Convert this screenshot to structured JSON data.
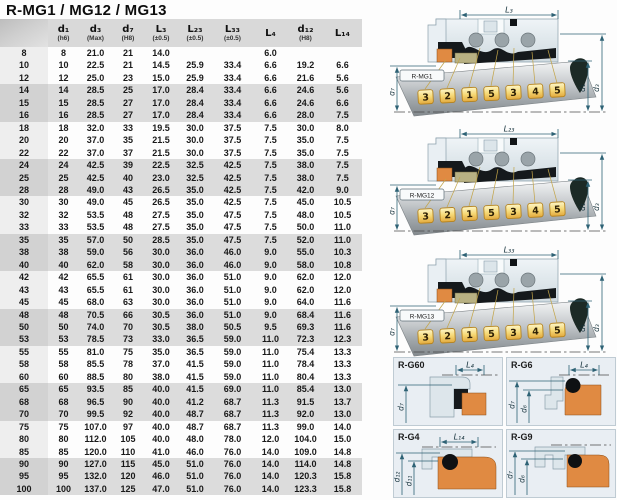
{
  "title": "R-MG1 / MG12 / MG13",
  "table": {
    "headers": [
      {
        "name": "d₁",
        "tol": "(h6)"
      },
      {
        "name": "d₃",
        "tol": "(Max)"
      },
      {
        "name": "d₇",
        "tol": "(H8)"
      },
      {
        "name": "L₃",
        "tol": "(±0.5)"
      },
      {
        "name": "L₂₃",
        "tol": "(±0.5)"
      },
      {
        "name": "L₃₃",
        "tol": "(±0.5)"
      },
      {
        "name": "L₄",
        "tol": ""
      },
      {
        "name": "d₁₂",
        "tol": "(H8)"
      },
      {
        "name": "L₁₄",
        "tol": ""
      }
    ],
    "rows": [
      [
        "8",
        "8",
        "21.0",
        "21",
        "14.0",
        "",
        "",
        "6.0",
        "",
        ""
      ],
      [
        "10",
        "10",
        "22.5",
        "21",
        "14.5",
        "25.9",
        "33.4",
        "6.6",
        "19.2",
        "6.6"
      ],
      [
        "12",
        "12",
        "25.0",
        "23",
        "15.0",
        "25.9",
        "33.4",
        "6.6",
        "21.6",
        "5.6"
      ],
      [
        "14",
        "14",
        "28.5",
        "25",
        "17.0",
        "28.4",
        "33.4",
        "6.6",
        "24.6",
        "5.6"
      ],
      [
        "15",
        "15",
        "28.5",
        "27",
        "17.0",
        "28.4",
        "33.4",
        "6.6",
        "24.6",
        "6.6"
      ],
      [
        "16",
        "16",
        "28.5",
        "27",
        "17.0",
        "28.4",
        "33.4",
        "6.6",
        "28.0",
        "7.5"
      ],
      [
        "18",
        "18",
        "32.0",
        "33",
        "19.5",
        "30.0",
        "37.5",
        "7.5",
        "30.0",
        "8.0"
      ],
      [
        "20",
        "20",
        "37.0",
        "35",
        "21.5",
        "30.0",
        "37.5",
        "7.5",
        "35.0",
        "7.5"
      ],
      [
        "22",
        "22",
        "37.0",
        "37",
        "21.5",
        "30.0",
        "37.5",
        "7.5",
        "35.0",
        "7.5"
      ],
      [
        "24",
        "24",
        "42.5",
        "39",
        "22.5",
        "32.5",
        "42.5",
        "7.5",
        "38.0",
        "7.5"
      ],
      [
        "25",
        "25",
        "42.5",
        "40",
        "23.0",
        "32.5",
        "42.5",
        "7.5",
        "38.0",
        "7.5"
      ],
      [
        "28",
        "28",
        "49.0",
        "43",
        "26.5",
        "35.0",
        "42.5",
        "7.5",
        "42.0",
        "9.0"
      ],
      [
        "30",
        "30",
        "49.0",
        "45",
        "26.5",
        "35.0",
        "42.5",
        "7.5",
        "45.0",
        "10.5"
      ],
      [
        "32",
        "32",
        "53.5",
        "48",
        "27.5",
        "35.0",
        "47.5",
        "7.5",
        "48.0",
        "10.5"
      ],
      [
        "33",
        "33",
        "53.5",
        "48",
        "27.5",
        "35.0",
        "47.5",
        "7.5",
        "50.0",
        "11.0"
      ],
      [
        "35",
        "35",
        "57.0",
        "50",
        "28.5",
        "35.0",
        "47.5",
        "7.5",
        "52.0",
        "11.0"
      ],
      [
        "38",
        "38",
        "59.0",
        "56",
        "30.0",
        "36.0",
        "46.0",
        "9.0",
        "55.0",
        "10.3"
      ],
      [
        "40",
        "40",
        "62.0",
        "58",
        "30.0",
        "36.0",
        "46.0",
        "9.0",
        "58.0",
        "10.8"
      ],
      [
        "42",
        "42",
        "65.5",
        "61",
        "30.0",
        "36.0",
        "51.0",
        "9.0",
        "62.0",
        "12.0"
      ],
      [
        "43",
        "43",
        "65.5",
        "61",
        "30.0",
        "36.0",
        "51.0",
        "9.0",
        "62.0",
        "12.0"
      ],
      [
        "45",
        "45",
        "68.0",
        "63",
        "30.0",
        "36.0",
        "51.0",
        "9.0",
        "64.0",
        "11.6"
      ],
      [
        "48",
        "48",
        "70.5",
        "66",
        "30.5",
        "36.0",
        "51.0",
        "9.0",
        "68.4",
        "11.6"
      ],
      [
        "50",
        "50",
        "74.0",
        "70",
        "30.5",
        "38.0",
        "50.5",
        "9.5",
        "69.3",
        "11.6"
      ],
      [
        "53",
        "53",
        "78.5",
        "73",
        "33.0",
        "36.5",
        "59.0",
        "11.0",
        "72.3",
        "12.3"
      ],
      [
        "55",
        "55",
        "81.0",
        "75",
        "35.0",
        "36.5",
        "59.0",
        "11.0",
        "75.4",
        "13.3"
      ],
      [
        "58",
        "58",
        "85.5",
        "78",
        "37.0",
        "41.5",
        "59.0",
        "11.0",
        "78.4",
        "13.3"
      ],
      [
        "60",
        "60",
        "88.5",
        "80",
        "38.0",
        "41.5",
        "59.0",
        "11.0",
        "80.4",
        "13.3"
      ],
      [
        "65",
        "65",
        "93.5",
        "85",
        "40.0",
        "41.5",
        "69.0",
        "11.0",
        "85.4",
        "13.0"
      ],
      [
        "68",
        "68",
        "96.5",
        "90",
        "40.0",
        "41.2",
        "68.7",
        "11.3",
        "91.5",
        "13.7"
      ],
      [
        "70",
        "70",
        "99.5",
        "92",
        "40.0",
        "48.7",
        "68.7",
        "11.3",
        "92.0",
        "13.0"
      ],
      [
        "75",
        "75",
        "107.0",
        "97",
        "40.0",
        "48.7",
        "68.7",
        "11.3",
        "99.0",
        "14.0"
      ],
      [
        "80",
        "80",
        "112.0",
        "105",
        "40.0",
        "48.0",
        "78.0",
        "12.0",
        "104.0",
        "15.0"
      ],
      [
        "85",
        "85",
        "120.0",
        "110",
        "41.0",
        "46.0",
        "76.0",
        "14.0",
        "109.0",
        "14.8"
      ],
      [
        "90",
        "90",
        "127.0",
        "115",
        "45.0",
        "51.0",
        "76.0",
        "14.0",
        "114.0",
        "14.8"
      ],
      [
        "95",
        "95",
        "132.0",
        "120",
        "46.0",
        "51.0",
        "76.0",
        "14.0",
        "120.3",
        "15.8"
      ],
      [
        "100",
        "100",
        "137.0",
        "125",
        "47.0",
        "51.0",
        "76.0",
        "14.0",
        "123.3",
        "15.8"
      ]
    ]
  },
  "diagrams": [
    {
      "label": "R-MG1",
      "top_dim": "L₃",
      "left_dim": "d₇",
      "right_dims": [
        "d₁",
        "d₃"
      ],
      "tags": [
        "3",
        "2",
        "1",
        "5",
        "3",
        "4",
        "5"
      ]
    },
    {
      "label": "R-MG12",
      "top_dim": "L₂₃",
      "left_dim": "d₇",
      "right_dims": [
        "d₁",
        "d₃"
      ],
      "tags": [
        "3",
        "2",
        "1",
        "5",
        "3",
        "4",
        "5"
      ]
    },
    {
      "label": "R-MG13",
      "top_dim": "L₃₃",
      "left_dim": "d₇",
      "right_dims": [
        "d₁",
        "d₃"
      ],
      "tags": [
        "3",
        "2",
        "1",
        "5",
        "3",
        "4",
        "5"
      ]
    }
  ],
  "detail_panels": [
    {
      "label": "R-G60",
      "top_dim": "L₄",
      "left_dims": [
        "d₇",
        ""
      ]
    },
    {
      "label": "R-G6",
      "top_dim": "L₄",
      "left_dims": [
        "d₇",
        "d₆"
      ]
    },
    {
      "label": "R-G4",
      "top_dim": "L₁₄",
      "left_dims": [
        "d₁₂",
        "d₁₁"
      ]
    },
    {
      "label": "R-G9",
      "top_dim": "",
      "left_dims": [
        "d₇",
        "d₆"
      ]
    }
  ],
  "colors": {
    "header_bg": "#d9d9d9",
    "band_bg": "#dcdcdc",
    "dim": "#2e6275",
    "orange": "#e08a42",
    "olive": "#b8b183",
    "tag_yellow": "#f6d976",
    "black_part": "#15191c"
  }
}
